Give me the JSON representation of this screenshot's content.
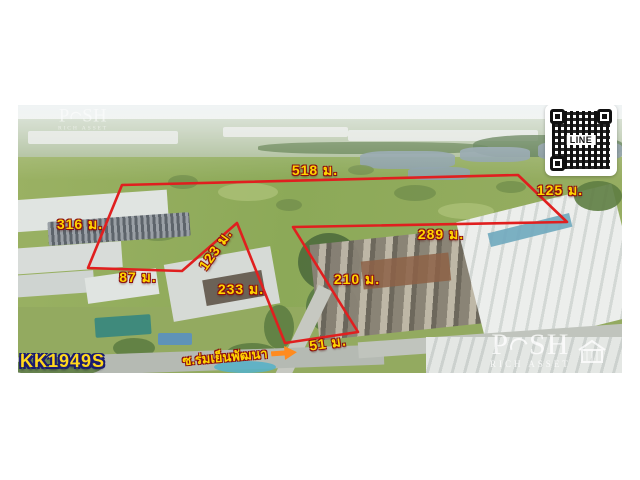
{
  "listing": {
    "code": "KK1949S"
  },
  "qr": {
    "label": "LINE"
  },
  "watermark": {
    "p": "P",
    "sh": "SH",
    "subtitle": "RICH ASSET"
  },
  "street": {
    "name": "ซ.ร่มเย็นพัฒนา"
  },
  "boundary": {
    "line_color": "#e01f1f",
    "label_color": "#ffd400",
    "measurements": [
      "518 ม.",
      "125 ม.",
      "316 ม.",
      "289 ม.",
      "123 ม.",
      "87 ม.",
      "233 ม.",
      "210 ม.",
      "51 ม."
    ]
  }
}
